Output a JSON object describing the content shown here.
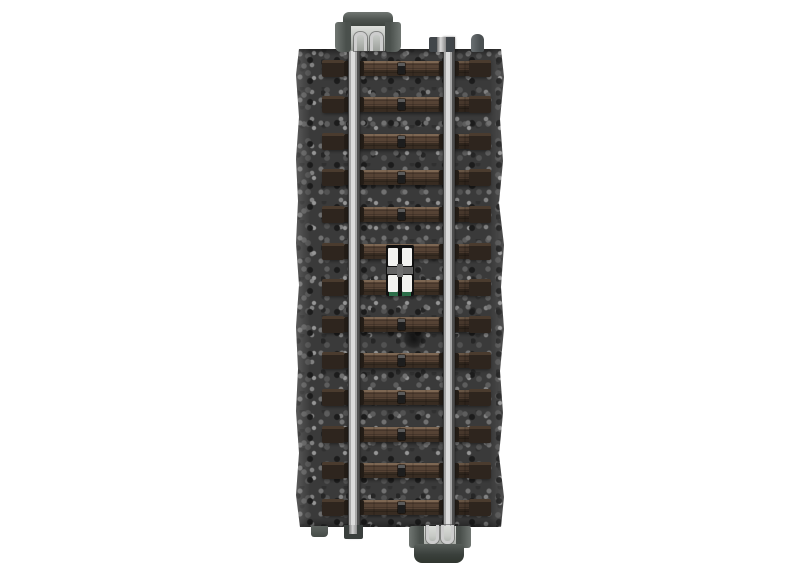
{
  "scene": {
    "type": "product-photo",
    "subject": "Model railway straight track section with dark gray gravel ballast roadbed, two silver metal rails, brown wooden ties with center stud contacts, a white center contact plate in the middle, and dark gray snap-lock rail joiner clips at the top and bottom ends, photographed on a white background in vertical orientation",
    "orientation": "vertical",
    "background_color": "#ffffff"
  },
  "track": {
    "tie_count": 13,
    "parts": {
      "ballast_bed": "molded gravel roadbed",
      "rails": "two parallel metal rails",
      "ties": "wood-grain sleepers with center stud contacts",
      "center_contact": "white contact plate with two slotted modules and green circuit board edge",
      "top_connector": "rail joiner housing with two metal wire clips",
      "bottom_connector": "rail joiner housing with two metal wire clips",
      "alignment_peg": "small round peg at top right",
      "alignment_tab": "small tab at bottom left"
    },
    "colors": {
      "background": "#ffffff",
      "ballast_base": "#3a3a3a",
      "tie_wood": "#564335",
      "tie_wood_light": "#7d6753",
      "tie_wood_dark": "#382c22",
      "tie_end": "#2e251e",
      "clip": "#241d17",
      "stud": "#1d1d1d",
      "rail_bright": "#dcdcdc",
      "rail_mid": "#a8a8a8",
      "rail_dark": "#4f4f4f",
      "rail_edge": "#3f3f3f",
      "housing": "#4a504c",
      "housing_light": "#707672",
      "housing_inner": "#c7cac6",
      "wire": "#cdcdcd",
      "contact_white": "#f2f2f0",
      "contact_black": "#101010",
      "contact_cross": "#646464",
      "pcb_green": "#2c6e49"
    },
    "layout": {
      "first_tie_center_y": 68,
      "tie_spacing": 36.6
    }
  }
}
